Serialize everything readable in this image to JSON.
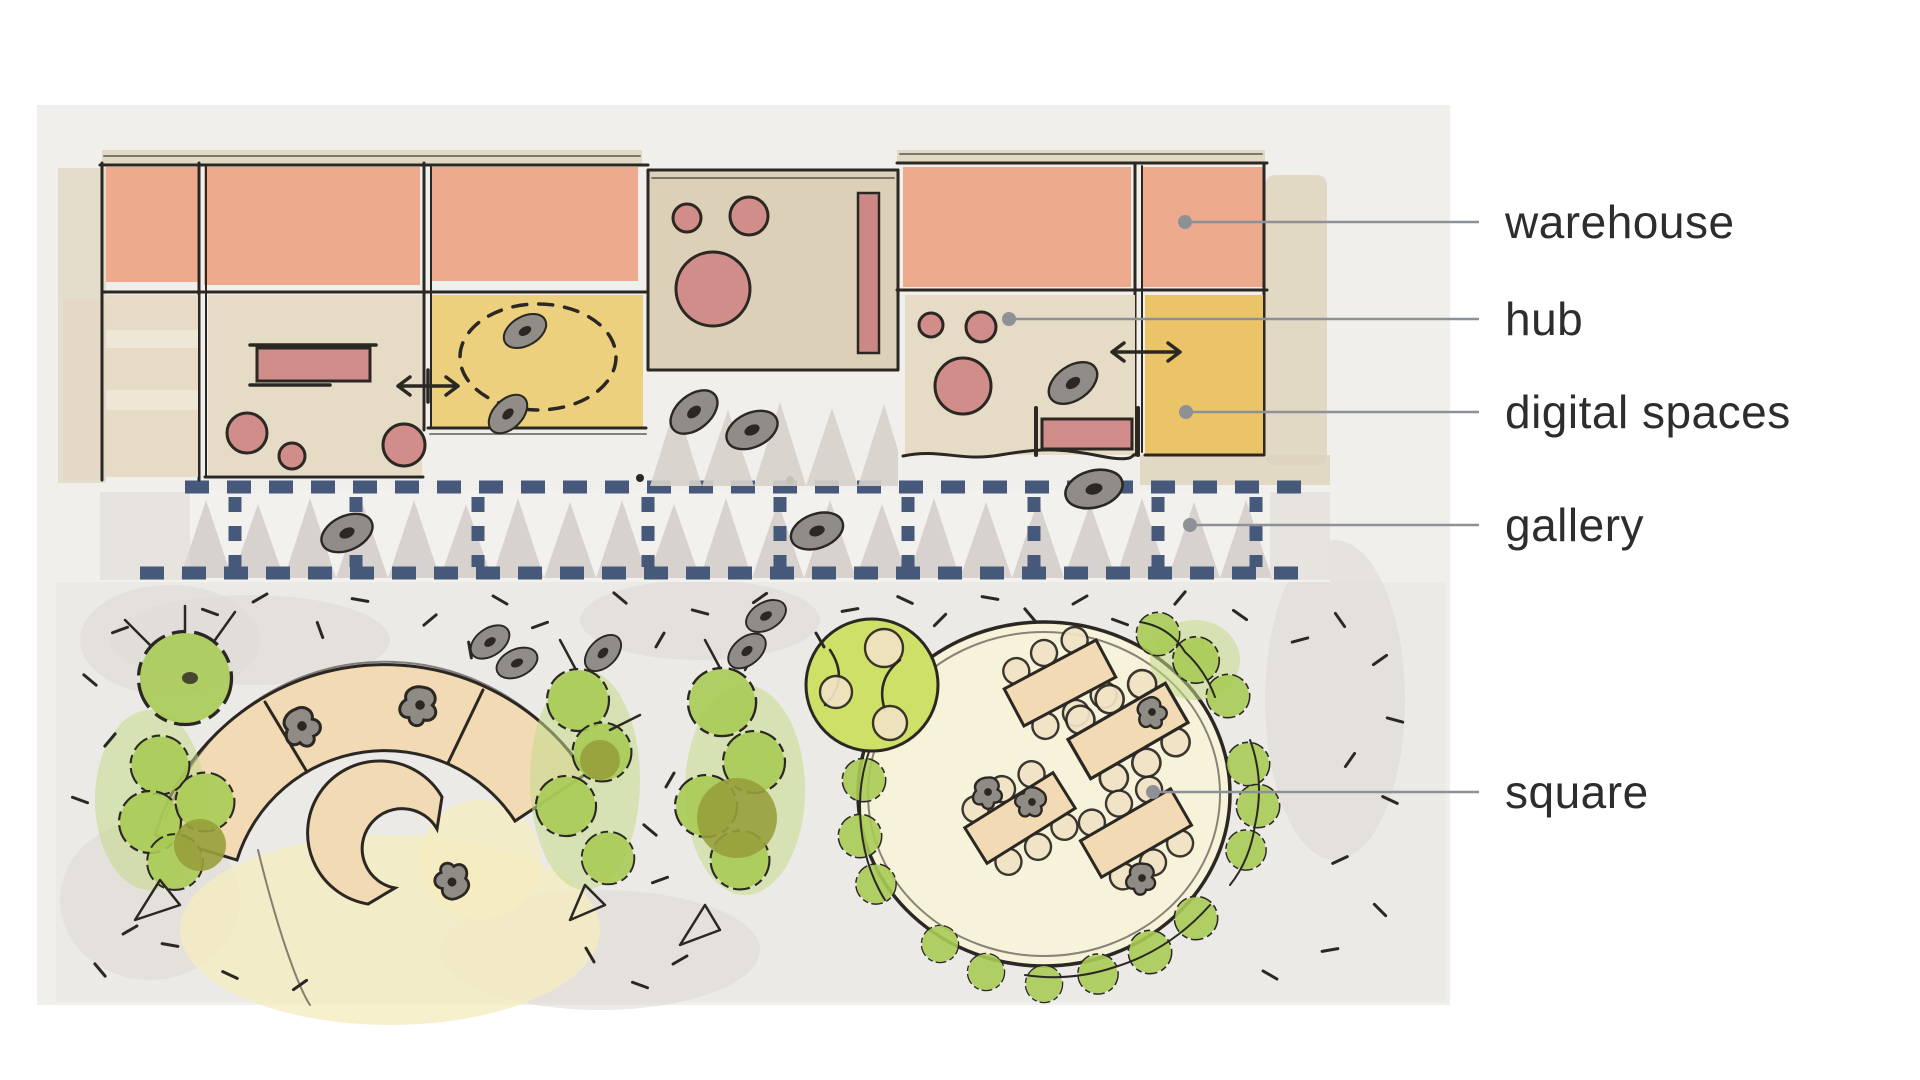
{
  "labels": [
    {
      "id": "warehouse",
      "text": "warehouse"
    },
    {
      "id": "hub",
      "text": "hub"
    },
    {
      "id": "digital-spaces",
      "text": "digital spaces"
    },
    {
      "id": "gallery",
      "text": "gallery"
    },
    {
      "id": "square",
      "text": "square"
    }
  ],
  "palette": {
    "paper": "#f1efec",
    "salmon": "#edaa8c",
    "pink": "#d08d89",
    "beige": "#e6dbc5",
    "beige2": "#dcd1b8",
    "tan": "#f2dbb4",
    "yellow": "#edd07e",
    "yellow2": "#ecc468",
    "lime": "#cfe068",
    "green": "#a9cb55",
    "olive": "#97a03c",
    "ink": "#2b2722",
    "dash": "#46597a",
    "zig": "#d6d0cb",
    "ground": "#eceae6",
    "leader": "#8d9196",
    "label": "#2d2d2d"
  }
}
